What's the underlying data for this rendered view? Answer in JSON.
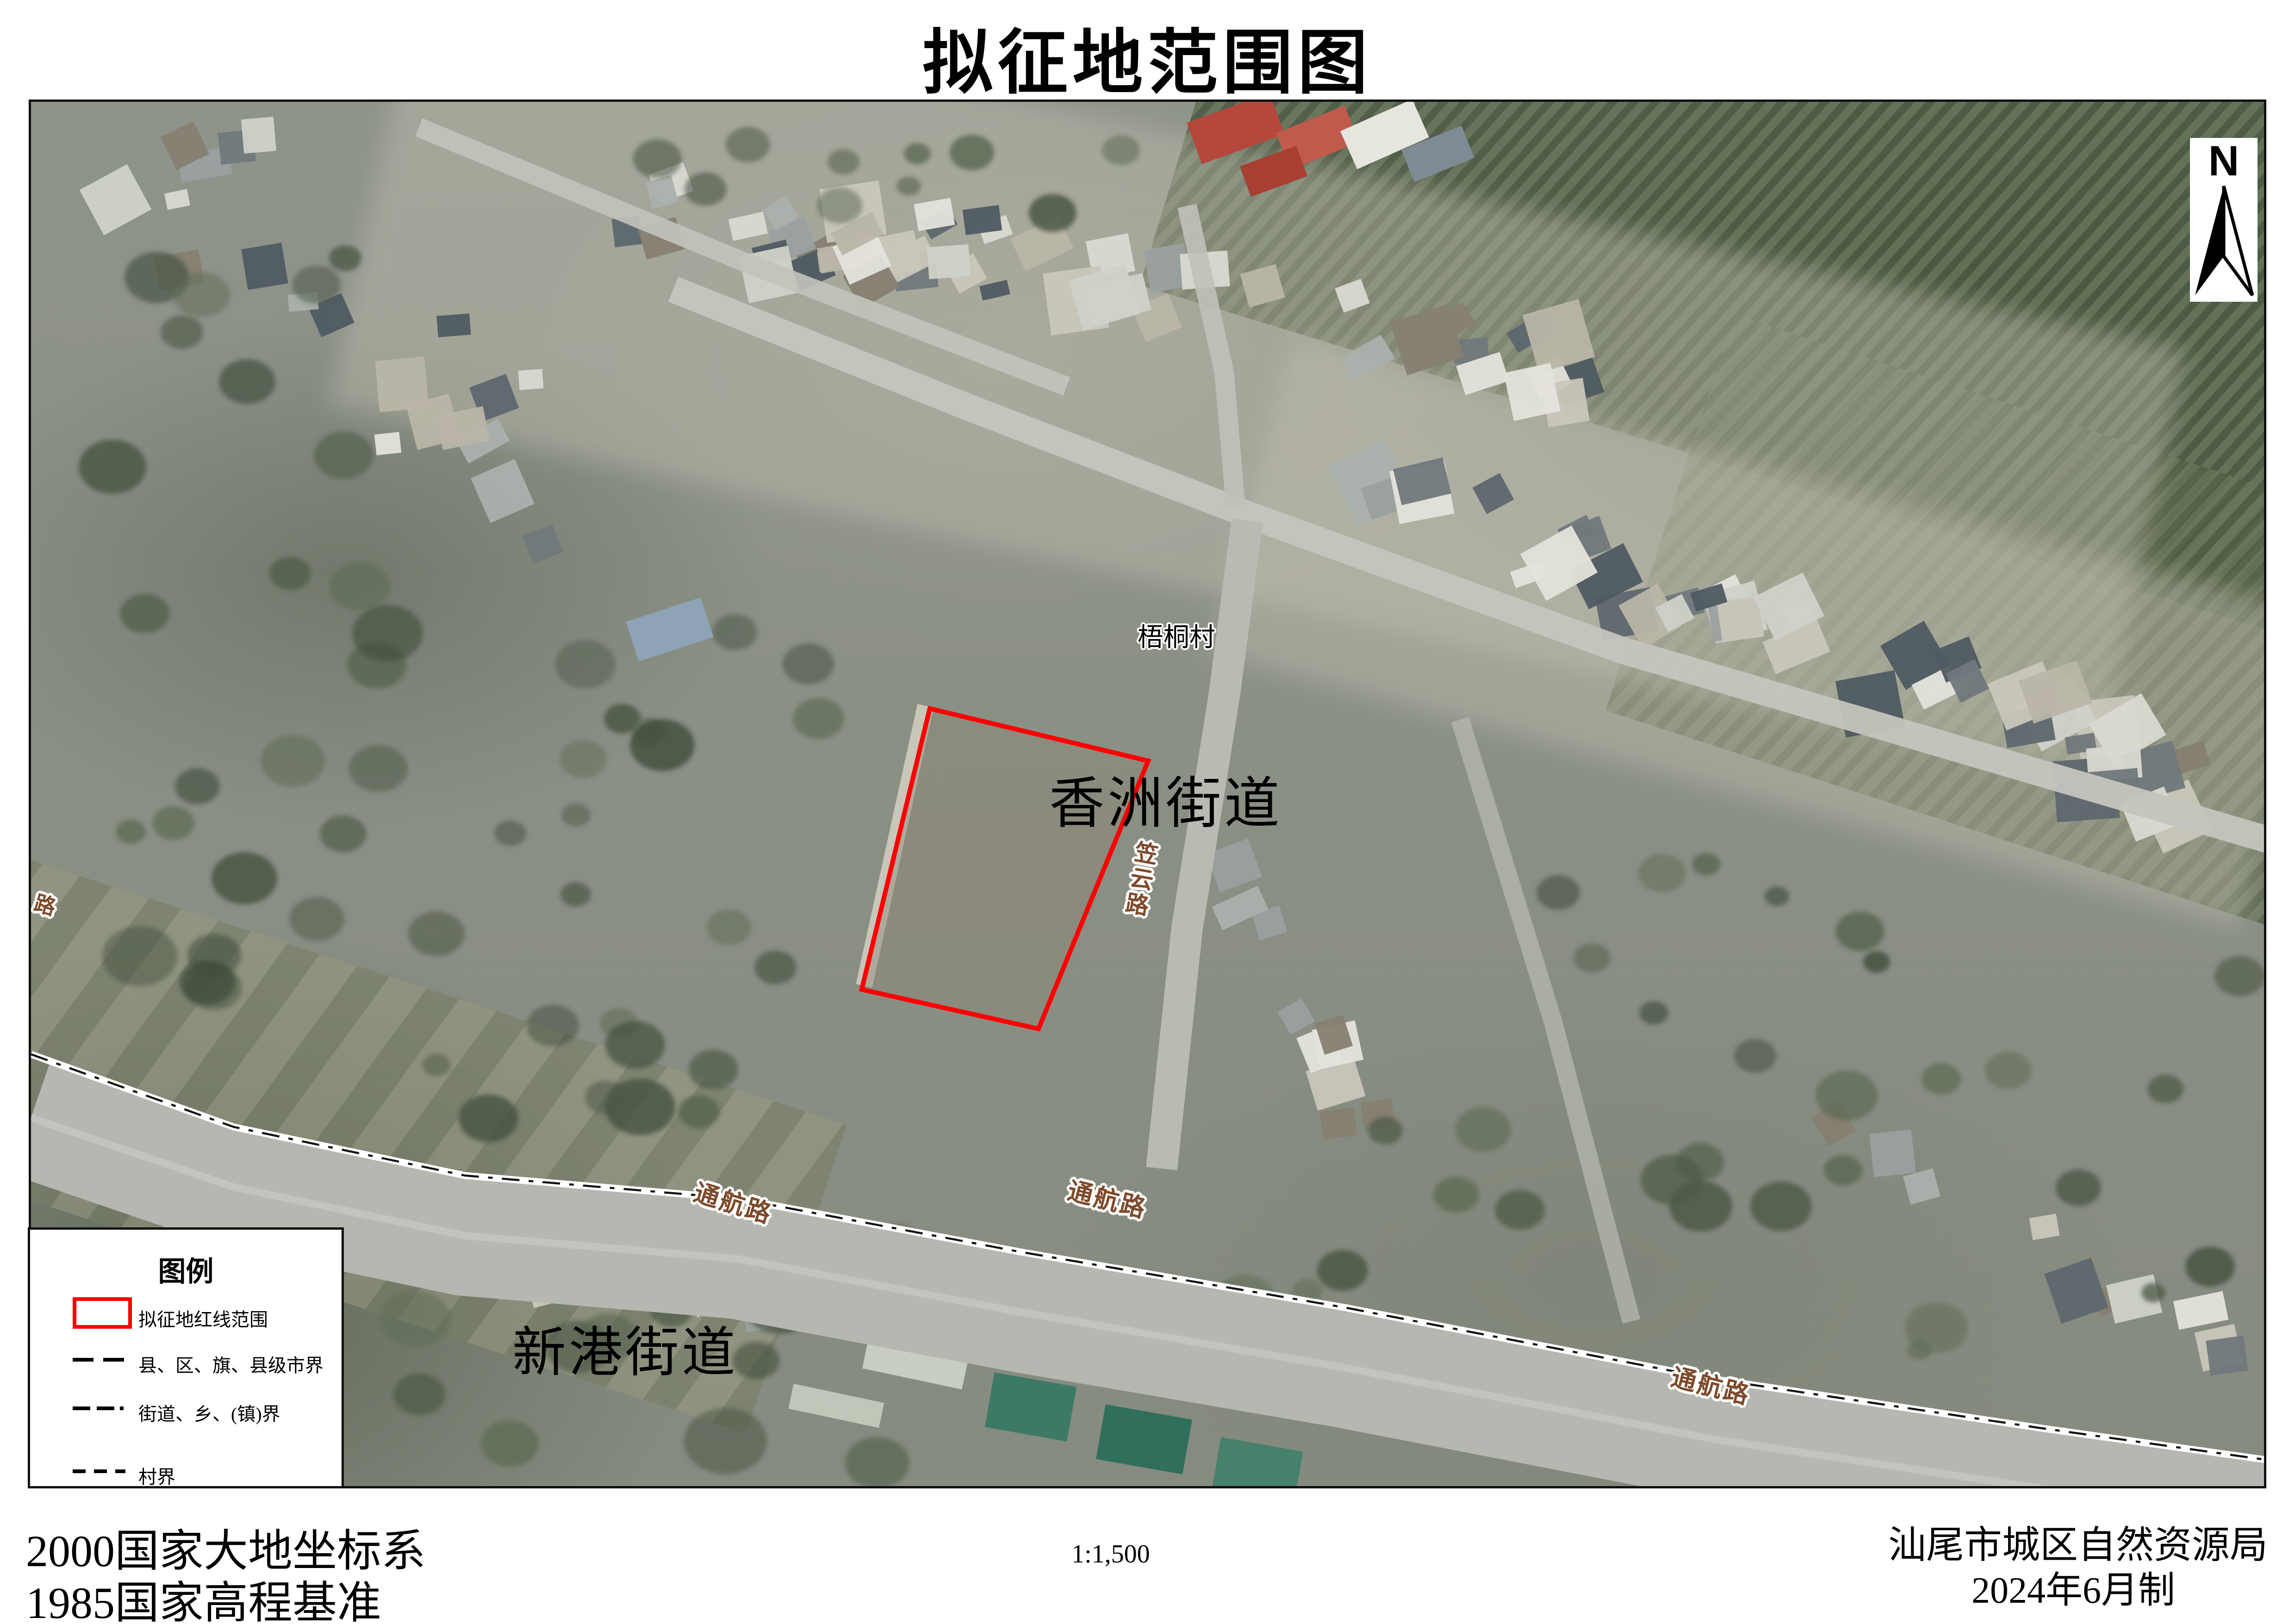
{
  "title": "拟征地范围图",
  "north_arrow": {
    "label": "N"
  },
  "map_labels": {
    "village": "梧桐村",
    "street_xiangzhou": "香洲街道",
    "street_xingang": "新港街道",
    "road_liyun": "笠云路",
    "road_tonghang": "通航路",
    "road_fragment": "路"
  },
  "legend": {
    "title": "图例",
    "items": [
      {
        "symbol": "red-rectangle",
        "label": "拟征地红线范围"
      },
      {
        "symbol": "long-dash-line",
        "label": "县、区、旗、县级市界"
      },
      {
        "symbol": "dash-dash-dot-line",
        "label": "街道、乡、(镇)界"
      },
      {
        "symbol": "short-dash-line",
        "label": "村界"
      }
    ]
  },
  "footer": {
    "datum_line1": "2000国家大地坐标系",
    "datum_line2": "1985国家高程基准",
    "scale_text": "1:1,500",
    "agency": "汕尾市城区自然资源局",
    "date": "2024年6月制"
  },
  "colors": {
    "redline": "#fe0000",
    "road_label_brown": "#7d4a2b",
    "boundary_casing": "#ffffff",
    "boundary_dash": "#111111"
  }
}
